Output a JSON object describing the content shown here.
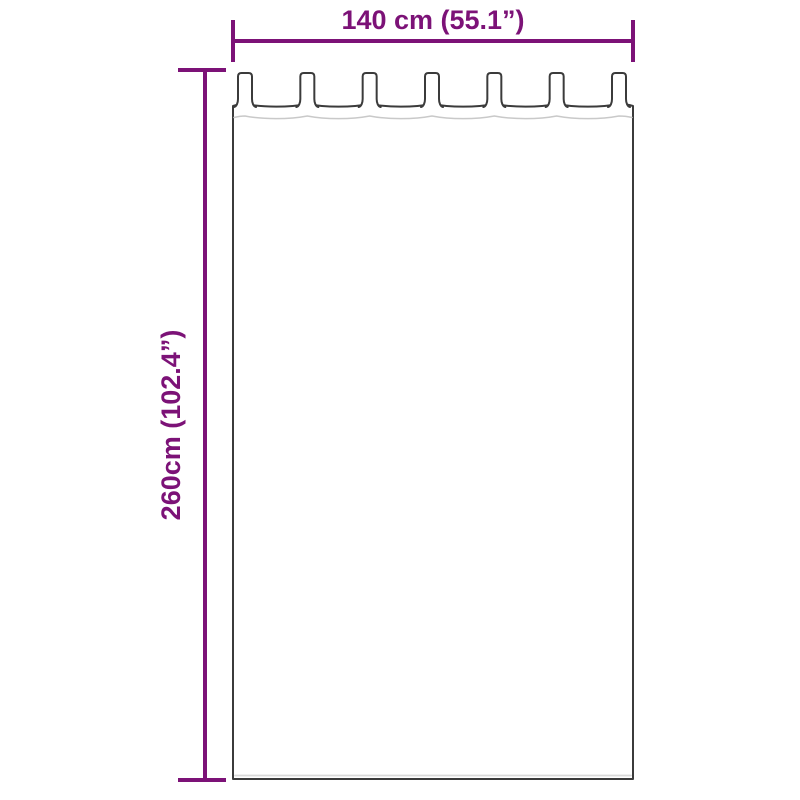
{
  "diagram": {
    "kind": "product-dimension-diagram",
    "subject": "tab-top-curtain",
    "width_label": "140 cm (55.1”)",
    "height_label": "260cm (102.4”)",
    "tab_count": 7,
    "colors": {
      "accent": "#7c1277",
      "outline": "#3b3b3b",
      "seam": "#c9c9c9",
      "hem_highlight": "#d9d9d9",
      "background": "#ffffff",
      "fabric": "#ffffff"
    }
  }
}
